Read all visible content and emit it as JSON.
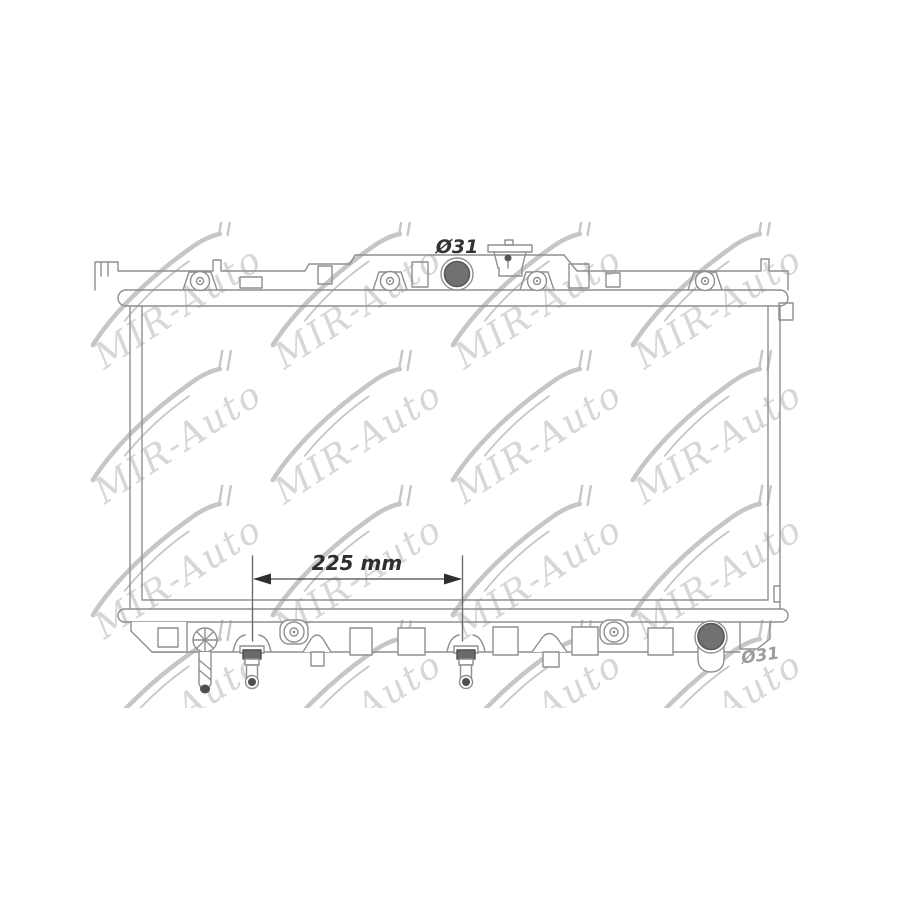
{
  "watermark": {
    "text": "MIR-Auto",
    "text_color": "#d7d7d7",
    "swoosh_color": "#c6c6c6"
  },
  "annotations": {
    "top_port_diameter": {
      "text": "Ø31",
      "color": "#333333"
    },
    "bottom_port_diameter": {
      "text": "Ø31",
      "color": "#9b9b9b"
    },
    "fitting_distance": {
      "text": "225 mm",
      "color": "#2e2e2e"
    }
  },
  "drawing": {
    "subject": "automotive radiator line drawing",
    "line_color": "#8f8f8f",
    "port_fill": "#717171",
    "port_ring": "#575757",
    "fitting_fill": "#4f4f4f",
    "dimension_color": "#3a3a3a",
    "background": "#ffffff"
  }
}
